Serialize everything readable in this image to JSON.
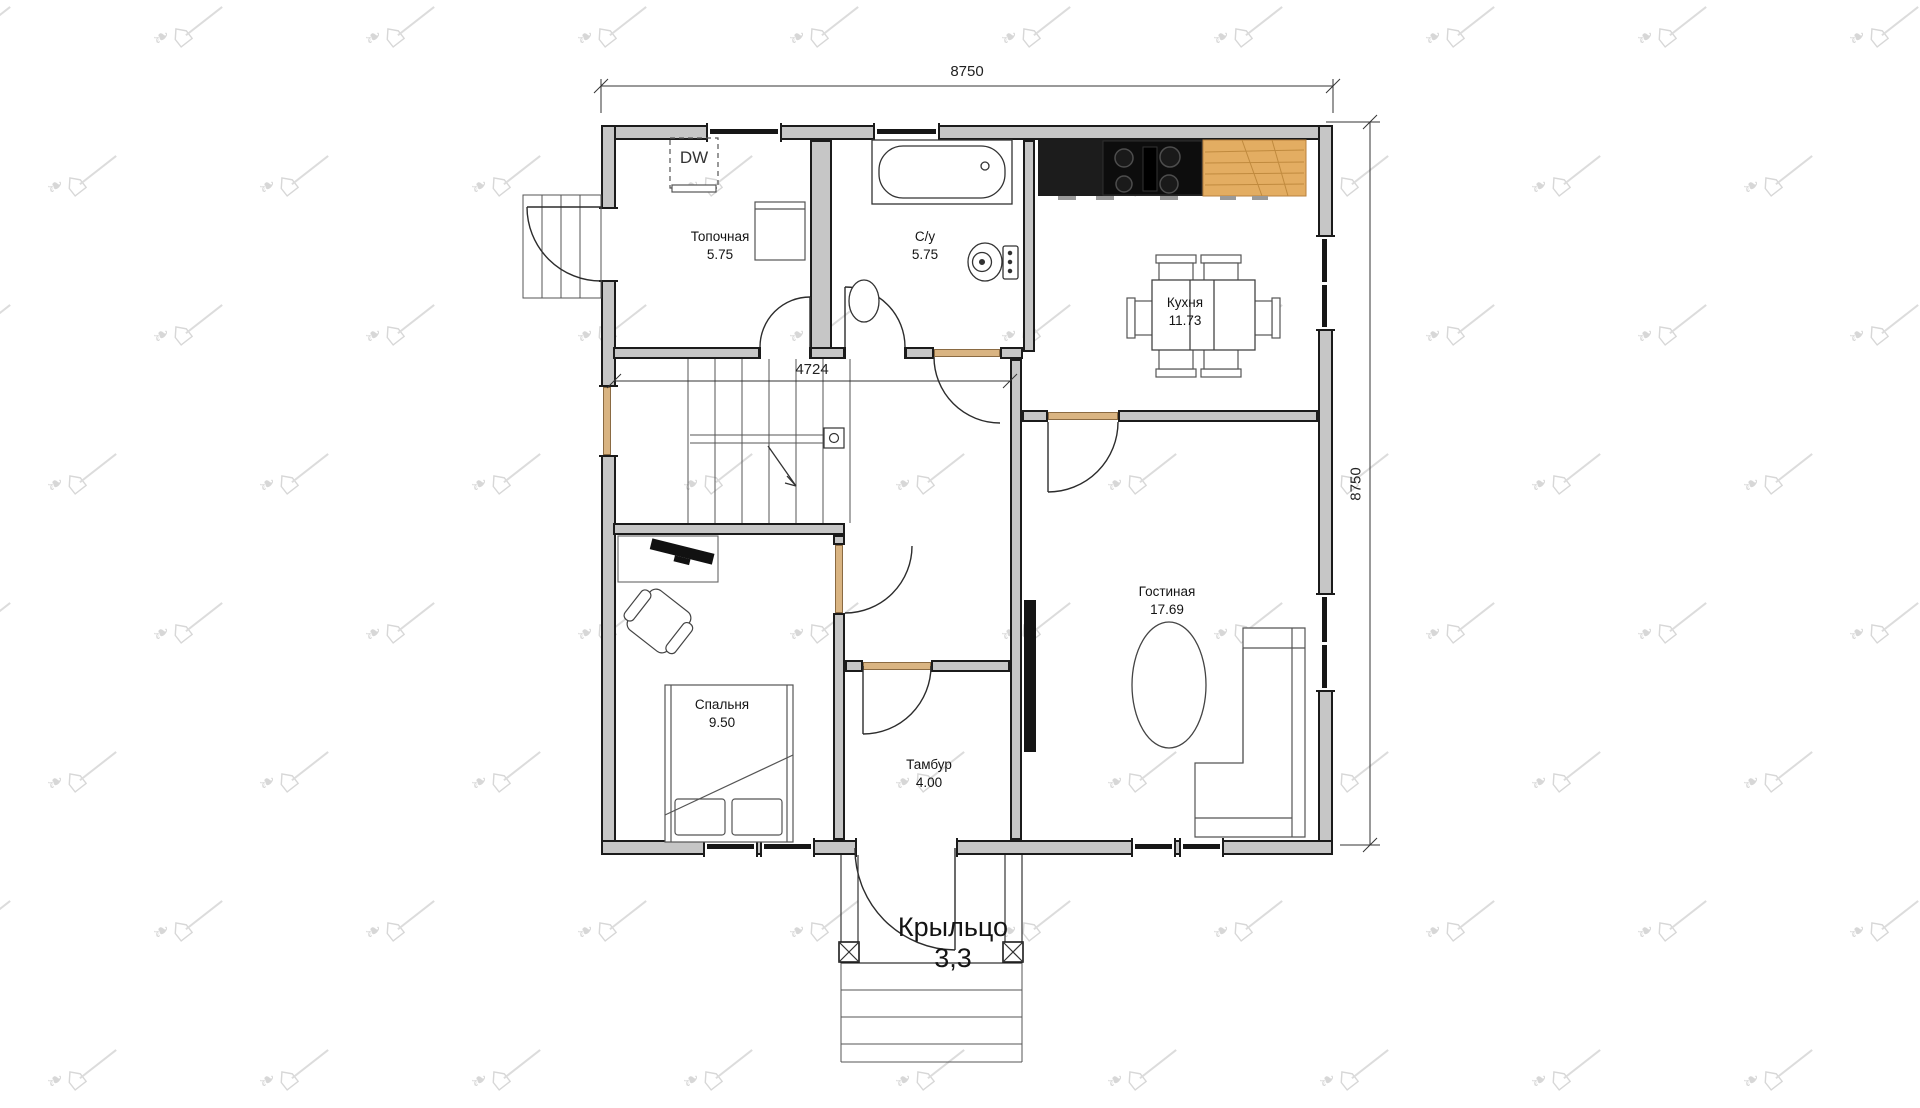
{
  "plan": {
    "dimensions": {
      "overall_width": "8750",
      "overall_height": "8750",
      "hall_width": "4724"
    },
    "rooms": [
      {
        "name": "Топочная",
        "area": "5.75"
      },
      {
        "name": "С/у",
        "area": "5.75"
      },
      {
        "name": "Кухня",
        "area": "11.73"
      },
      {
        "name": "Гостиная",
        "area": "17.69"
      },
      {
        "name": "Спальня",
        "area": "9.50"
      },
      {
        "name": "Тамбур",
        "area": "4.00"
      },
      {
        "name": "Крыльцо",
        "area": "3,3"
      }
    ],
    "labels": {
      "dishwasher": "DW"
    },
    "watermark": {
      "house_glyph": "⌂",
      "bird_glyph": "❧"
    },
    "colors": {
      "wall_fill": "#c6c6c6",
      "wall_edge": "#1b1b1b",
      "counter_black": "#1c1c1c",
      "counter_wood": "#e3ad62",
      "door_threshold": "#d9b482",
      "watermark": "#d7d7d7"
    }
  }
}
